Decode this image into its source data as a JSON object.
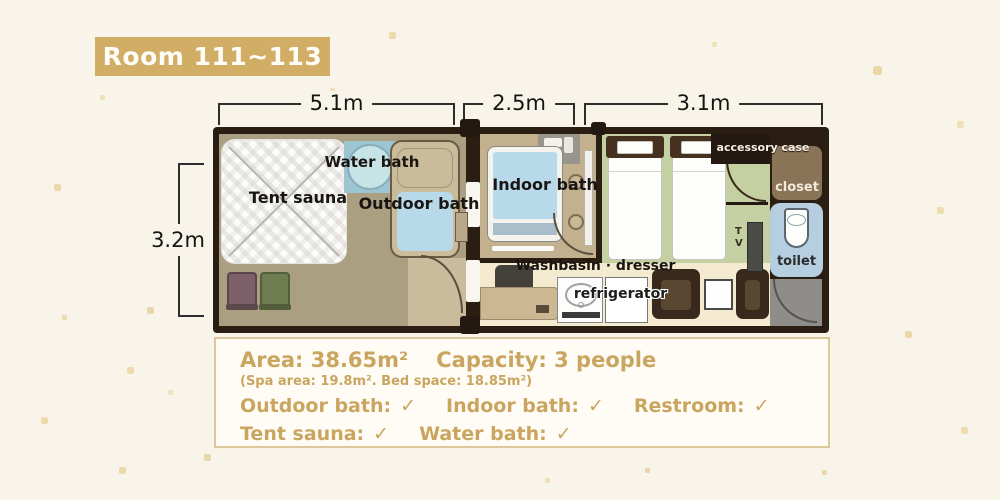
{
  "badge": {
    "title": "Room 111~113"
  },
  "dimensions": {
    "top_spa": "5.1m",
    "top_bath": "2.5m",
    "top_bedroom": "3.1m",
    "left_depth": "3.2m"
  },
  "plan_labels": {
    "tent_sauna": "Tent sauna",
    "water_bath": "Water bath",
    "outdoor_bath": "Outdoor bath",
    "indoor_bath": "Indoor bath",
    "washbasin_dresser": "Washbasin · dresser",
    "refrigerator": "refrigerator",
    "accessory_case": "accessory case",
    "closet": "closet",
    "toilet": "toilet",
    "tv": "TV"
  },
  "info_box": {
    "area": "Area: 38.65m²",
    "capacity": "Capacity: 3 people",
    "sub_note": "(Spa area: 19.8m². Bed space: 18.85m²)",
    "features_row1": [
      {
        "label": "Outdoor bath:",
        "check": "✓"
      },
      {
        "label": "Indoor bath:",
        "check": "✓"
      },
      {
        "label": "Restroom:",
        "check": "✓"
      }
    ],
    "features_row2": [
      {
        "label": "Tent sauna:",
        "check": "✓"
      },
      {
        "label": "Water bath:",
        "check": "✓"
      }
    ]
  },
  "colors": {
    "accent": "#d2ad66",
    "info_text": "#c9a55f",
    "wall": "#2a1e13",
    "spa_floor": "#ab9f82",
    "indoor_floor": "#c2b08f",
    "bedroom_floor": "#c5d0a2",
    "wash_floor": "#f4ead0",
    "water": "#b7d9ea",
    "toilet_room": "#b5cee0",
    "closet": "#8a7458",
    "entrance": "#8e8d89",
    "background": "#f8f4ea"
  }
}
